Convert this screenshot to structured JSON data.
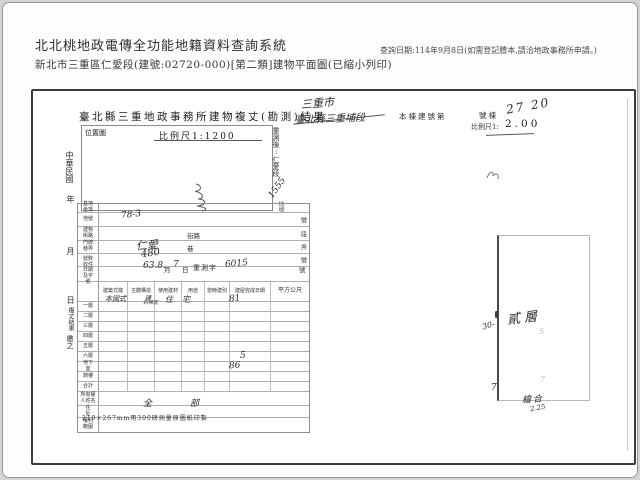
{
  "header": {
    "system_title": "北北桃地政電傳全功能地籍資料查詢系統",
    "subtitle": "新北市三重區仁愛段(建號:02720-000)[第二類]建物平面圖(已縮小列印)",
    "query_note": "查詢日期:114年9月8日(如需登記謄本,請洽地政事務所申請。)"
  },
  "document": {
    "title": "臺北縣三重地政事務所建物複丈(勘測)結果",
    "location_map": {
      "label": "位置圖",
      "scale": "比例尺1:1200"
    },
    "remeasure": {
      "prefix": "重測後:仁愛段",
      "number": "1555",
      "suffix": "地號"
    },
    "top": {
      "hand_city": "三重市",
      "hand_old_section": "臺北縣三重埔段",
      "building_no_label": "本棟建號第",
      "building_no_suffix": "號棟",
      "hand_building_no": "27 20",
      "scale_label": "比例尺1:",
      "scale_value": "2.00"
    },
    "margin": [
      "中華民國",
      "年",
      "月",
      "日",
      "複丈結果",
      "繳之"
    ],
    "form": {
      "rows": [
        {
          "label": "基地坐落",
          "unit": ""
        },
        {
          "label": "地號",
          "unit": "號"
        },
        {
          "label": "建物街路",
          "mid": "街路",
          "unit": "段"
        },
        {
          "label": "門牌巷弄",
          "mid": "巷",
          "unit": "弄"
        },
        {
          "label": "號數",
          "mid": "",
          "unit": "號"
        },
        {
          "label": "收件日期及字號",
          "unit": ""
        }
      ],
      "hand_values": {
        "parcel_no": "78-3",
        "street": "仁愛",
        "house_no": "480"
      },
      "receipt": [
        "63.8.",
        "月",
        "7",
        "日",
        "重測字",
        "6015",
        "號"
      ],
      "area_header": [
        "建築式樣",
        "主體構造",
        "使用建材",
        "用途",
        "當時建別",
        "建屋完成日期",
        "平方公尺"
      ],
      "floors": [
        {
          "label": "一層",
          "style": "本國式",
          "structure": "磚",
          "material": "石棉瓦",
          "use_1": "住",
          "use_2": "宅",
          "area": "81"
        },
        {
          "label": "二層",
          "area": ""
        },
        {
          "label": "三層",
          "area": ""
        },
        {
          "label": "四層",
          "area": ""
        },
        {
          "label": "五層",
          "area": ""
        },
        {
          "label": "六層",
          "area": ""
        },
        {
          "label": "地下室",
          "area": ""
        },
        {
          "label": "騎樓",
          "area": "5"
        },
        {
          "label": "合計",
          "area": "86"
        }
      ],
      "owner_label": "所有權人姓名",
      "address_label": "住　址",
      "rights_label": "權利範圍",
      "rights_value_1": "全",
      "rights_value_2": "部",
      "footnote": "210×267mm用300磅測量原圖紙印製"
    },
    "plan": {
      "floor_label": "貳層",
      "dim_left": "30-",
      "dim_bottom_left": "7",
      "faint_mid": "5",
      "faint_low": "7",
      "bottom_label": "繪合",
      "bottom_value": "2.25"
    }
  }
}
